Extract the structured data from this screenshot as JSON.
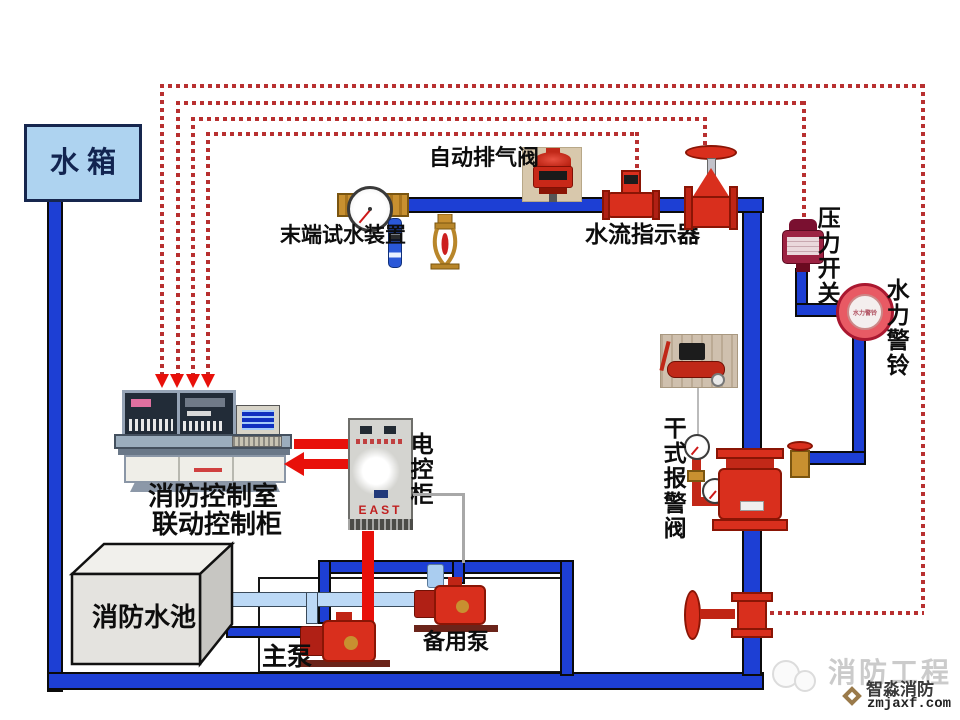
{
  "components": {
    "water_tank": {
      "label": "水  箱"
    },
    "auto_air_vent": {
      "label": "自动排气阀"
    },
    "terminal_test_device": {
      "label": "末端试水装置"
    },
    "water_flow_indicator": {
      "label": "水流指示器"
    },
    "pressure_switch": {
      "label": "压力开关"
    },
    "water_motor_alarm_bell": {
      "label": "水力警铃",
      "dial_text": "水力警铃"
    },
    "dry_pipe_alarm_valve": {
      "label": "干式报警阀"
    },
    "fire_control_room": {
      "label_line1": "消防控制室",
      "label_line2": "联动控制柜"
    },
    "electric_control_cabinet": {
      "label": "电控柜",
      "brand": "EAST"
    },
    "fire_water_pool": {
      "label": "消防水池"
    },
    "main_pump": {
      "label": "主泵"
    },
    "standby_pump": {
      "label": "备用泵"
    }
  },
  "watermark": {
    "ghost_text": "消防工程",
    "brand": "智淼消防",
    "site": "zmjaxf.com"
  },
  "colors": {
    "pipe_blue": "#1d3fd4",
    "suction_light_blue": "#bcd9f6",
    "signal_dotted_red": "#b83030",
    "arrow_red": "#e8100a",
    "device_red": "#d92f1d",
    "brass": "#c89030",
    "tank_fill": "#aed3f0"
  }
}
